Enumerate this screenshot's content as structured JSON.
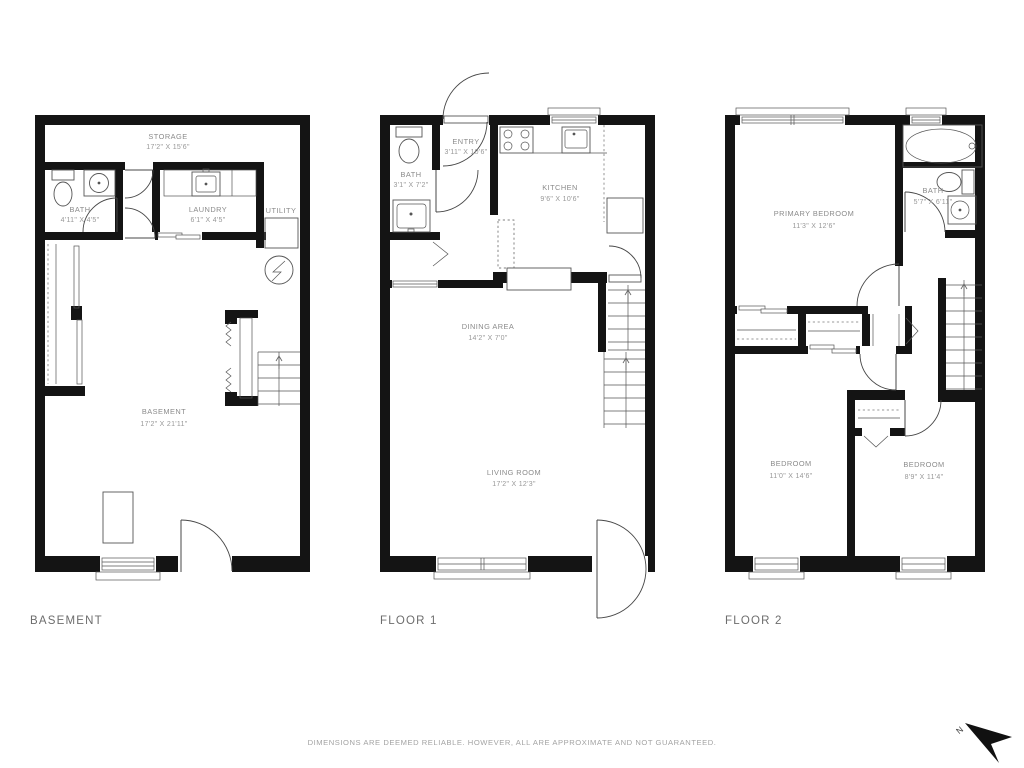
{
  "floors": {
    "basement": {
      "label": "BASEMENT",
      "rooms": {
        "storage": {
          "name": "STORAGE",
          "dims": "17'2\" X 15'6\""
        },
        "bath": {
          "name": "BATH",
          "dims": "4'11\" X 4'5\""
        },
        "laundry": {
          "name": "LAUNDRY",
          "dims": "6'1\" X 4'5\""
        },
        "utility": {
          "name": "UTILITY"
        },
        "main": {
          "name": "BASEMENT",
          "dims": "17'2\" X 21'11\""
        }
      }
    },
    "floor1": {
      "label": "FLOOR 1",
      "rooms": {
        "entry": {
          "name": "ENTRY",
          "dims": "3'11\" X 10'6\""
        },
        "bath": {
          "name": "BATH",
          "dims": "3'1\" X 7'2\""
        },
        "kitchen": {
          "name": "KITCHEN",
          "dims": "9'6\" X 10'6\""
        },
        "dining": {
          "name": "DINING AREA",
          "dims": "14'2\" X 7'0\""
        },
        "living": {
          "name": "LIVING ROOM",
          "dims": "17'2\" X 12'3\""
        }
      }
    },
    "floor2": {
      "label": "FLOOR 2",
      "rooms": {
        "primary": {
          "name": "PRIMARY BEDROOM",
          "dims": "11'3\" X 12'6\""
        },
        "bath": {
          "name": "BATH",
          "dims": "5'7\" X 6'11\""
        },
        "bedroom_left": {
          "name": "BEDROOM",
          "dims": "11'0\" X 14'6\""
        },
        "bedroom_right": {
          "name": "BEDROOM",
          "dims": "8'9\" X 11'4\""
        }
      }
    }
  },
  "footer": {
    "disclaimer": "DIMENSIONS ARE DEEMED RELIABLE. HOWEVER, ALL ARE APPROXIMATE AND NOT GUARANTEED."
  },
  "compass": {
    "label": "N"
  },
  "colors": {
    "wall": "#141414",
    "line": "#555555",
    "label": "#8b8b8b",
    "floor_label": "#6d6d6d",
    "footer": "#a3a3a3"
  }
}
